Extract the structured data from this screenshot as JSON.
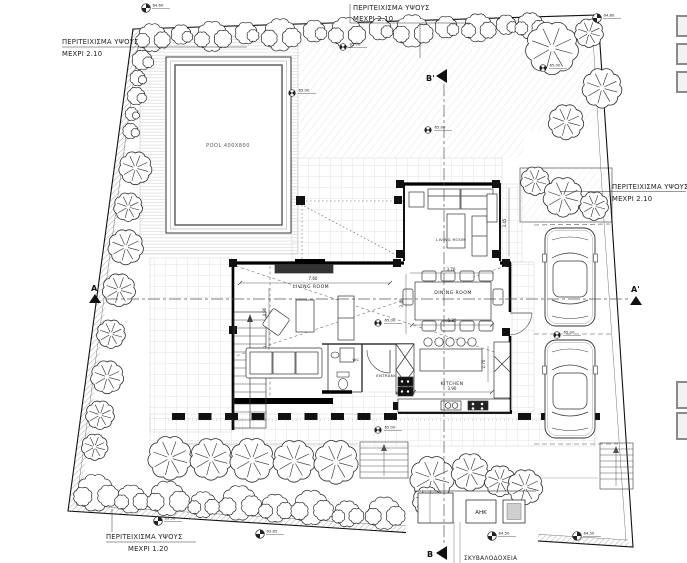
{
  "labels": {
    "perimeter_top_left": {
      "line1": "ΠΕΡΙΤΕΙΧΙΣΜΑ ΥΨΟΥΣ",
      "line2": "ΜΕΧΡΙ 2.10"
    },
    "perimeter_top_center": {
      "line1": "ΠΕΡΙΤΕΙΧΙΣΜΑ ΥΨΟΥΣ",
      "line2": "ΜΕΧΡΙ 2.10"
    },
    "perimeter_right": {
      "line1": "ΠΕΡΙΤΕΙΧΙΣΜΑ ΥΨΟΥΣ",
      "line2": "ΜΕΧΡΙ 2.10"
    },
    "perimeter_bottom": {
      "line1": "ΠΕΡΙΤΕΙΧΙΣΜΑ ΥΨΟΥΣ",
      "line2": "ΜΕΧΡΙ 1.20"
    },
    "bins": "ΣΚΥΒΑΛΟΔΟΧΕΙΑ",
    "ahk": "ΑΗΚ",
    "pool": "POOL 400X800"
  },
  "rooms": {
    "living_upper": "LIVING ROOM",
    "living_main": "LIVING ROOM",
    "dining": "DINING ROOM",
    "kitchen": "KITCHEN",
    "entrance": "ENTRANCE",
    "wc": "WC"
  },
  "dimensions": {
    "living_width": "7.60",
    "living_depth": "4.90",
    "dining_side": "3.40",
    "dining_width": "5.30",
    "kitchen_width": "3.90",
    "kitchen_depth": "2.70",
    "upper_living_side": "3.45",
    "upper_living_width": "3.70"
  },
  "sections": {
    "a": "A",
    "a_prime": "A'",
    "b": "B",
    "b_prime": "B'"
  },
  "benchmarks": [
    {
      "x": 146,
      "y": 8,
      "value": "64.60",
      "type": "survey"
    },
    {
      "x": 597,
      "y": 18,
      "value": "64.80",
      "type": "survey"
    },
    {
      "x": 343,
      "y": 47,
      "value": "65.00",
      "type": "spot"
    },
    {
      "x": 543,
      "y": 68,
      "value": "65.00",
      "type": "spot"
    },
    {
      "x": 292,
      "y": 93,
      "value": "65.00",
      "type": "spot"
    },
    {
      "x": 428,
      "y": 130,
      "value": "65.00",
      "type": "spot"
    },
    {
      "x": 378,
      "y": 323,
      "value": "65.00",
      "type": "spot"
    },
    {
      "x": 378,
      "y": 430,
      "value": "65.00",
      "type": "spot"
    },
    {
      "x": 557,
      "y": 335,
      "value": "65.00",
      "type": "spot"
    },
    {
      "x": 158,
      "y": 521,
      "value": "63.50",
      "type": "survey"
    },
    {
      "x": 260,
      "y": 534,
      "value": "63.85",
      "type": "survey"
    },
    {
      "x": 492,
      "y": 536,
      "value": "64.50",
      "type": "survey"
    },
    {
      "x": 577,
      "y": 536,
      "value": "64.50",
      "type": "survey"
    }
  ],
  "colors": {
    "line": "#1a1a1a",
    "hatch": "#999999",
    "tile": "#d8d8d8",
    "grass": "#d9d9d9"
  }
}
